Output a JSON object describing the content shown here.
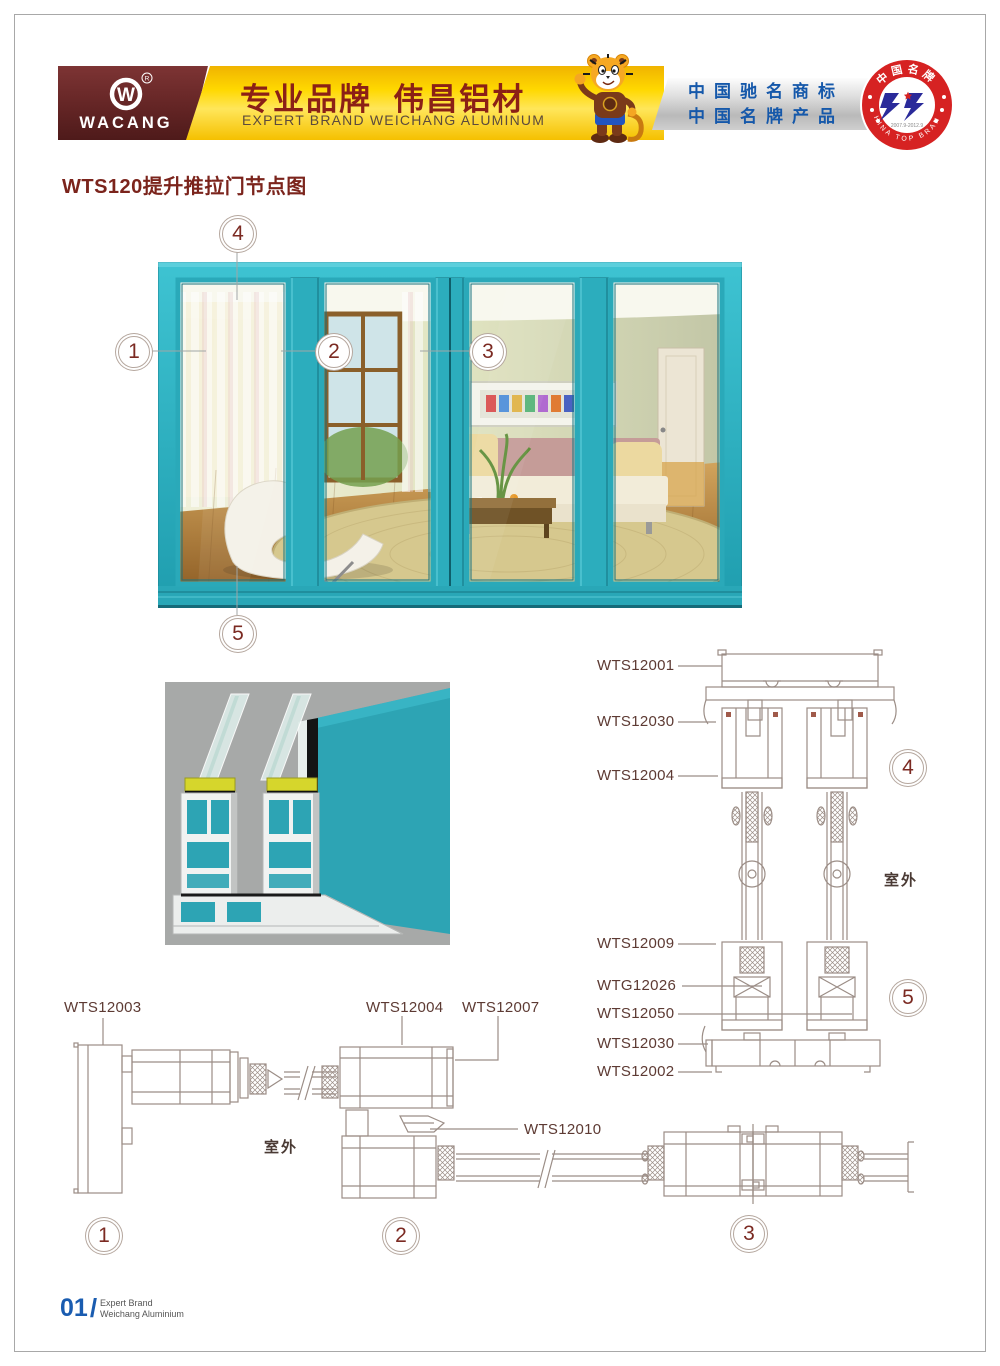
{
  "header": {
    "logo": "WACANG",
    "reg": "R",
    "slogan_cn": "专业品牌  伟昌铝材",
    "slogan_en": "EXPERT BRAND WEICHANG ALUMINUM",
    "honor1": "中国驰名商标",
    "honor2": "中国名牌产品",
    "badge": {
      "arc_top": "中国名牌",
      "arc_bottom": "CHINA TOP BRAND",
      "years": "2007.9-2012.9"
    }
  },
  "title": "WTS120提升推拉门节点图",
  "door": {
    "callout1": "1",
    "callout2": "2",
    "callout3": "3",
    "callout4": "4",
    "callout5": "5"
  },
  "vertical_section": {
    "labels": [
      "WTS12001",
      "WTS12030",
      "WTS12004",
      "WTS12009",
      "WTG12026",
      "WTS12050",
      "WTS12030",
      "WTS12002"
    ],
    "outdoor": "室外",
    "callout_top": "4",
    "callout_bottom": "5"
  },
  "horizontal_section": {
    "labels": [
      "WTS12003",
      "WTS12004",
      "WTS12007",
      "WTS12010"
    ],
    "outdoor": "室外",
    "callout1": "1",
    "callout2": "2",
    "callout3": "3"
  },
  "footer": {
    "page": "01",
    "line1": "Expert Brand",
    "line2": "Weichang Aluminium"
  },
  "colors": {
    "teal": "#2fb0c0",
    "maroon": "#7b241c",
    "blue": "#1558aa",
    "yellow": "#ffd800",
    "badge_red": "#d62222",
    "line": "#9b8d86"
  }
}
